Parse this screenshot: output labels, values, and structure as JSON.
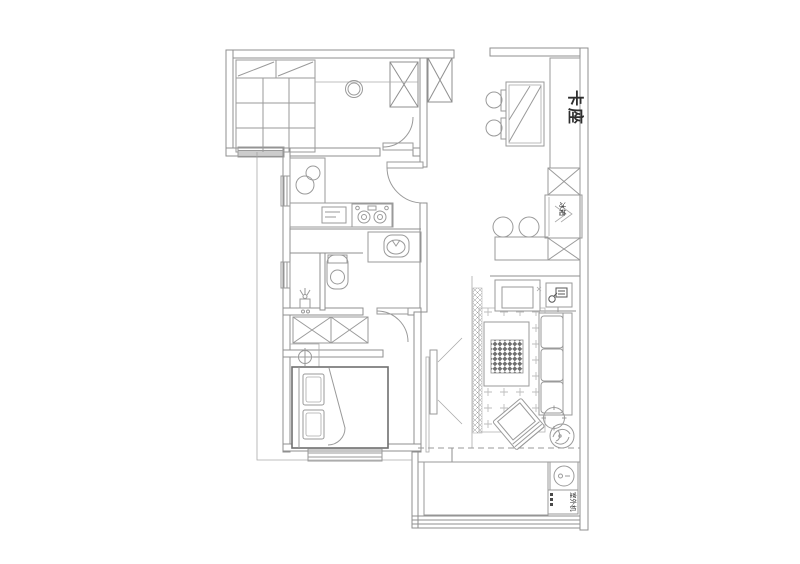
{
  "document": {
    "type": "residential floor plan drawing",
    "background": "#ffffff"
  },
  "labels": {
    "booth_seat": "卡座",
    "fridge": "冰箱",
    "outdoor_unit": "室外机"
  },
  "colors": {
    "wall_line": "#8f8f8f",
    "furniture_line": "#9a9a9a",
    "detail_dark": "#4a4a4a",
    "text": "#2e2e2e"
  }
}
